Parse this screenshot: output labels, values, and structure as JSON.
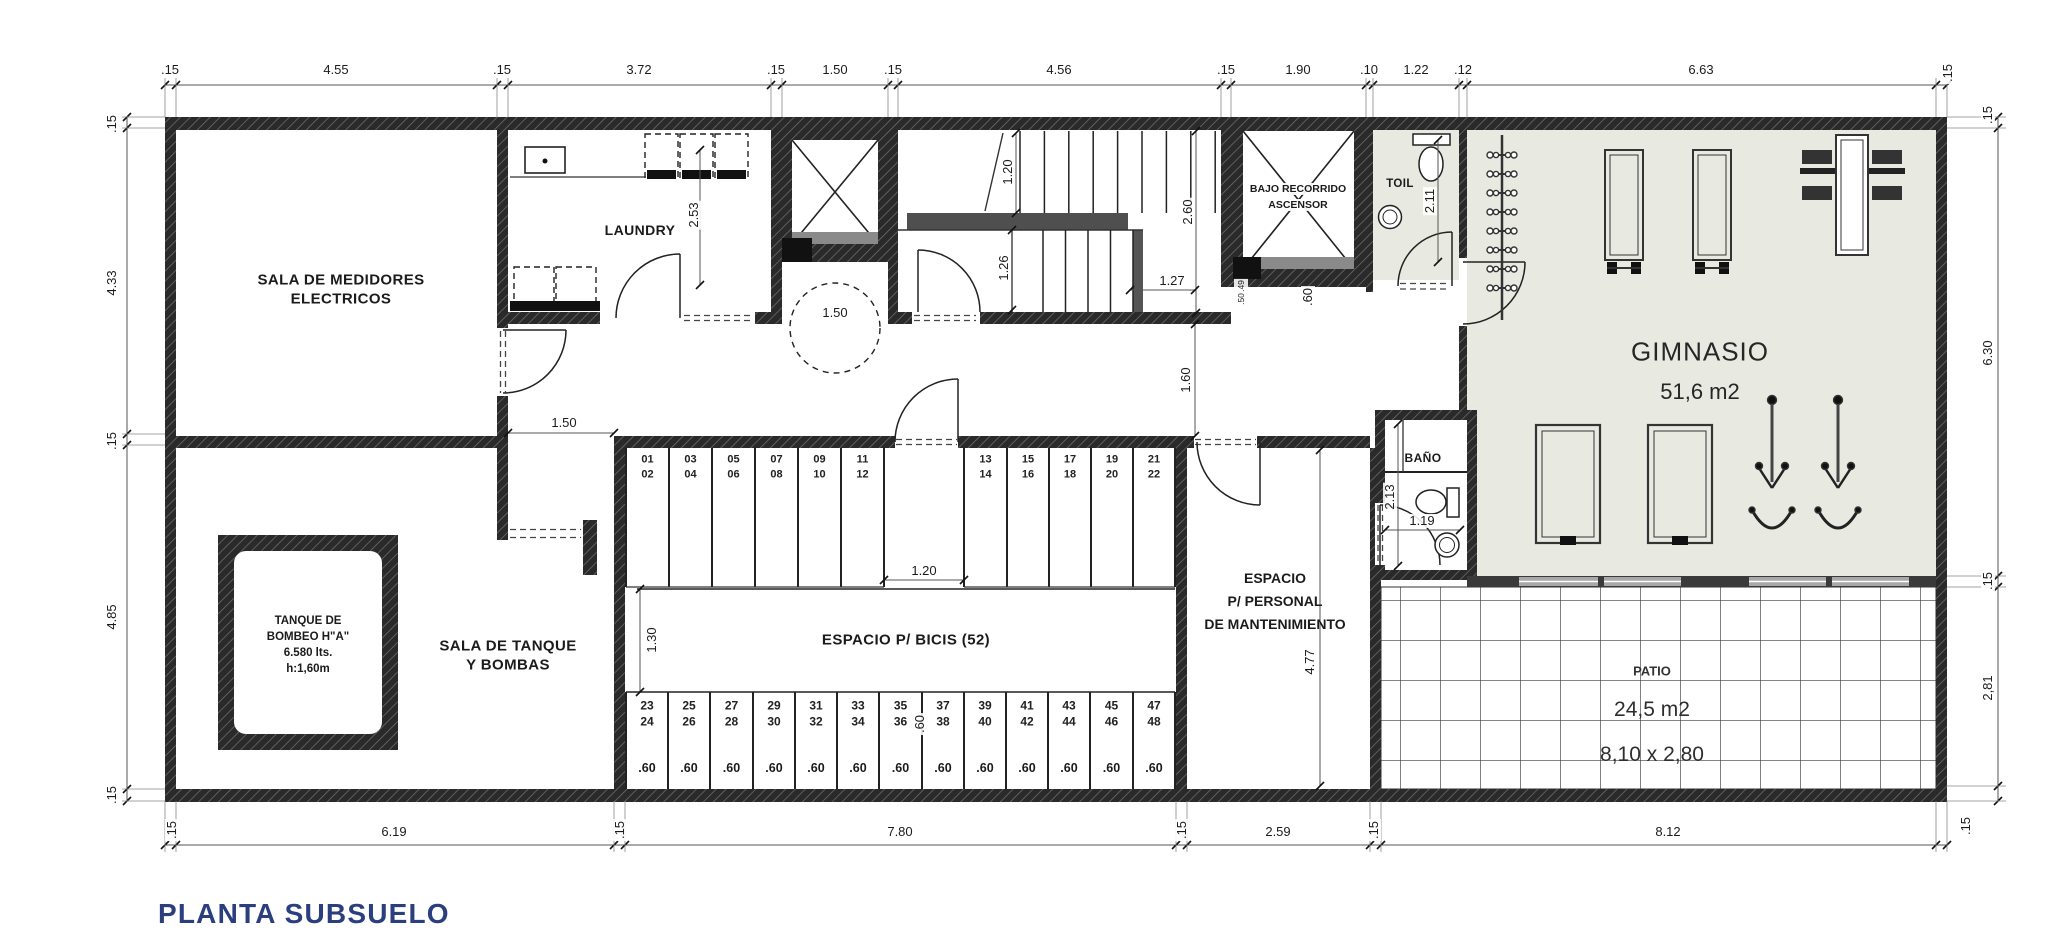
{
  "title": "PLANTA SUBSUELO",
  "rooms": {
    "medidores": {
      "l1": "SALA DE MEDIDORES",
      "l2": "ELECTRICOS"
    },
    "laundry": "LAUNDRY",
    "ascensor": {
      "l1": "BAJO RECORRIDO",
      "l2": "ASCENSOR"
    },
    "toil": "TOIL",
    "gym": {
      "name": "GIMNASIO",
      "area": "51,6 m2"
    },
    "tanque_sala": {
      "l1": "SALA DE TANQUE",
      "l2": "Y BOMBAS"
    },
    "tanque": {
      "l1": "TANQUE  DE",
      "l2": "BOMBEO  H\"A\"",
      "l3": "6.580  lts.",
      "l4": "h:1,60m"
    },
    "bicis": "ESPACIO P/ BICIS (52)",
    "personal": {
      "l1": "ESPACIO",
      "l2": "P/ PERSONAL",
      "l3": "DE MANTENIMIENTO"
    },
    "bano": "BAÑO",
    "patio": {
      "name": "PATIO",
      "area": "24,5 m2",
      "size": "8,10 x 2,80"
    }
  },
  "colors": {
    "title": "#2b3e7e",
    "gym_floor": "#e8eae2",
    "wall": "#2a2a2a"
  },
  "dimension_labels": [
    {
      "t": ".15",
      "x": 170,
      "y": 70,
      "r": 0
    },
    {
      "t": "4.55",
      "x": 336,
      "y": 70,
      "r": 0
    },
    {
      "t": ".15",
      "x": 502,
      "y": 70,
      "r": 0
    },
    {
      "t": "3.72",
      "x": 639,
      "y": 70,
      "r": 0
    },
    {
      "t": ".15",
      "x": 776,
      "y": 70,
      "r": 0
    },
    {
      "t": "1.50",
      "x": 835,
      "y": 70,
      "r": 0
    },
    {
      "t": ".15",
      "x": 893,
      "y": 70,
      "r": 0
    },
    {
      "t": "4.56",
      "x": 1059,
      "y": 70,
      "r": 0
    },
    {
      "t": ".15",
      "x": 1226,
      "y": 70,
      "r": 0
    },
    {
      "t": "1.90",
      "x": 1298,
      "y": 70,
      "r": 0
    },
    {
      "t": ".10",
      "x": 1369,
      "y": 70,
      "r": 0
    },
    {
      "t": "1.22",
      "x": 1416,
      "y": 70,
      "r": 0
    },
    {
      "t": ".12",
      "x": 1463,
      "y": 70,
      "r": 0
    },
    {
      "t": "6.63",
      "x": 1701,
      "y": 70,
      "r": 0
    },
    {
      "t": ".15",
      "x": 1948,
      "y": 73,
      "r": 1
    },
    {
      "t": ".15",
      "x": 112,
      "y": 124,
      "r": 1
    },
    {
      "t": "4.33",
      "x": 112,
      "y": 283,
      "r": 1
    },
    {
      "t": ".15",
      "x": 112,
      "y": 441,
      "r": 1
    },
    {
      "t": "4.85",
      "x": 112,
      "y": 617,
      "r": 1
    },
    {
      "t": ".15",
      "x": 112,
      "y": 795,
      "r": 1
    },
    {
      "t": ".15",
      "x": 1988,
      "y": 115,
      "r": 1
    },
    {
      "t": "6.30",
      "x": 1988,
      "y": 353,
      "r": 1
    },
    {
      "t": ".15",
      "x": 1988,
      "y": 581,
      "r": 1
    },
    {
      "t": "2,81",
      "x": 1988,
      "y": 688,
      "r": 1
    },
    {
      "t": ".15",
      "x": 172,
      "y": 830,
      "r": 1
    },
    {
      "t": "6.19",
      "x": 394,
      "y": 832,
      "r": 0
    },
    {
      "t": ".15",
      "x": 620,
      "y": 830,
      "r": 1
    },
    {
      "t": "7.80",
      "x": 900,
      "y": 832,
      "r": 0
    },
    {
      "t": ".15",
      "x": 1182,
      "y": 830,
      "r": 1
    },
    {
      "t": "2.59",
      "x": 1278,
      "y": 832,
      "r": 0
    },
    {
      "t": ".15",
      "x": 1374,
      "y": 830,
      "r": 1
    },
    {
      "t": "8.12",
      "x": 1668,
      "y": 832,
      "r": 0
    },
    {
      "t": ".15",
      "x": 1966,
      "y": 826,
      "r": 1
    },
    {
      "t": "2.53",
      "x": 694,
      "y": 215,
      "r": 1
    },
    {
      "t": "1.50",
      "x": 835,
      "y": 313,
      "r": 0
    },
    {
      "t": "1.20",
      "x": 1008,
      "y": 172,
      "r": 1
    },
    {
      "t": "2.60",
      "x": 1188,
      "y": 212,
      "r": 1
    },
    {
      "t": "1.26",
      "x": 1004,
      "y": 268,
      "r": 1
    },
    {
      "t": "1.27",
      "x": 1172,
      "y": 281,
      "r": 0
    },
    {
      "t": "1.60",
      "x": 1186,
      "y": 380,
      "r": 1
    },
    {
      "t": ".49",
      "x": 1241,
      "y": 286,
      "r": 1,
      "s": 1
    },
    {
      "t": ".50",
      "x": 1241,
      "y": 299,
      "r": 1,
      "s": 1
    },
    {
      "t": ".60",
      "x": 1308,
      "y": 297,
      "r": 1
    },
    {
      "t": "2.11",
      "x": 1430,
      "y": 201,
      "r": 1
    },
    {
      "t": "1.50",
      "x": 564,
      "y": 423,
      "r": 0
    },
    {
      "t": "1.20",
      "x": 924,
      "y": 571,
      "r": 0
    },
    {
      "t": "1.30",
      "x": 652,
      "y": 640,
      "r": 1
    },
    {
      "t": "4.77",
      "x": 1310,
      "y": 662,
      "r": 1
    },
    {
      "t": "2.13",
      "x": 1390,
      "y": 497,
      "r": 1
    },
    {
      "t": "1.19",
      "x": 1422,
      "y": 521,
      "r": 0
    },
    {
      "t": ".60",
      "x": 920,
      "y": 724,
      "r": 1
    }
  ],
  "bike": {
    "top": [
      [
        "01",
        "02"
      ],
      [
        "03",
        "04"
      ],
      [
        "05",
        "06"
      ],
      [
        "07",
        "08"
      ],
      [
        "09",
        "10"
      ],
      [
        "11",
        "12"
      ],
      [
        "13",
        "14"
      ],
      [
        "15",
        "16"
      ],
      [
        "17",
        "18"
      ],
      [
        "19",
        "20"
      ],
      [
        "21",
        "22"
      ]
    ],
    "bottom": [
      [
        "23",
        "24"
      ],
      [
        "25",
        "26"
      ],
      [
        "27",
        "28"
      ],
      [
        "29",
        "30"
      ],
      [
        "31",
        "32"
      ],
      [
        "33",
        "34"
      ],
      [
        "35",
        "36"
      ],
      [
        "37",
        "38"
      ],
      [
        "39",
        "40"
      ],
      [
        "41",
        "42"
      ],
      [
        "43",
        "44"
      ],
      [
        "45",
        "46"
      ],
      [
        "47",
        "48"
      ]
    ],
    "stall_width": ".60"
  }
}
